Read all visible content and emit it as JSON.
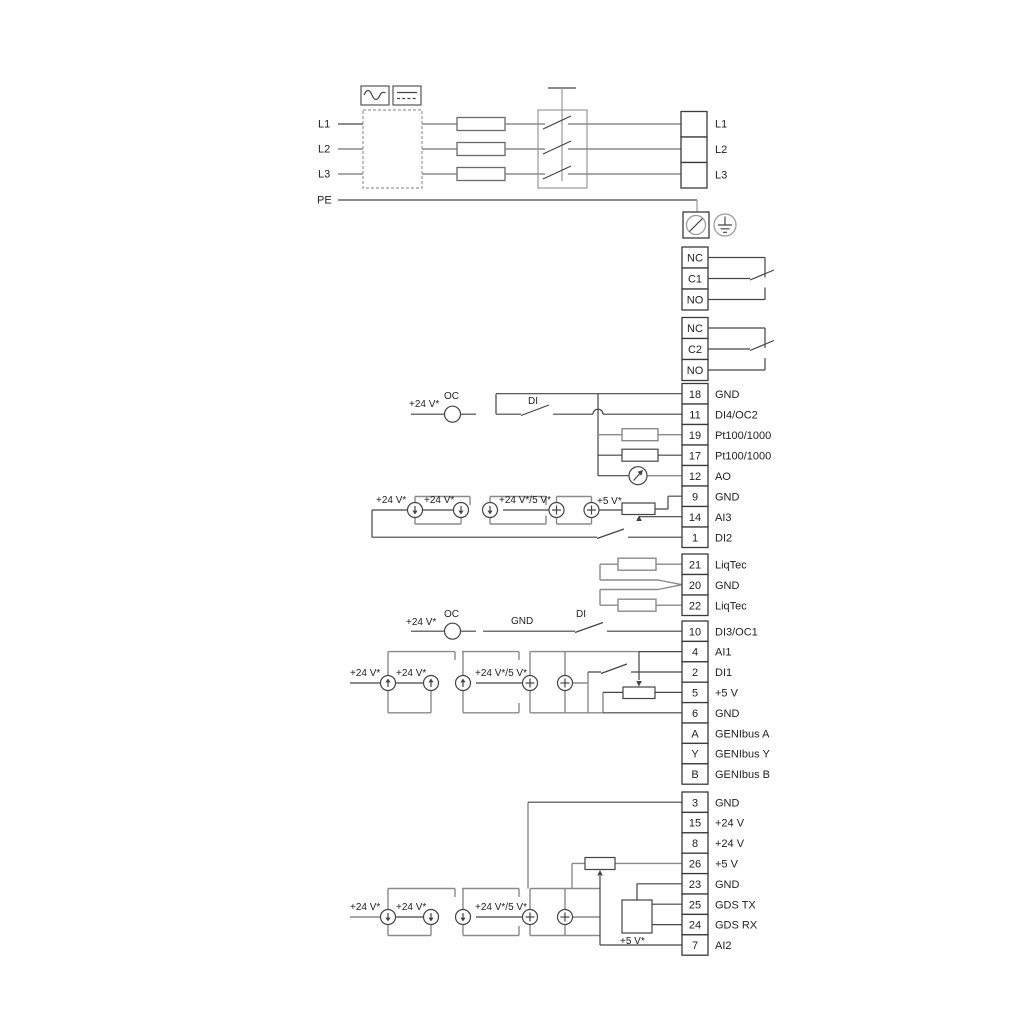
{
  "colors": {
    "wire": "#444444",
    "wire_grey": "#8a8a8a",
    "text": "#222222",
    "background": "#ffffff"
  },
  "power": {
    "inputs": [
      "L1",
      "L2",
      "L3",
      "PE"
    ],
    "out": [
      "L1",
      "L2",
      "L3"
    ]
  },
  "relays": {
    "r1": [
      "NC",
      "C1",
      "NO"
    ],
    "r2": [
      "NC",
      "C2",
      "NO"
    ]
  },
  "terminals": [
    {
      "num": "18",
      "label": "GND"
    },
    {
      "num": "11",
      "label": "DI4/OC2"
    },
    {
      "num": "19",
      "label": "Pt100/1000"
    },
    {
      "num": "17",
      "label": "Pt100/1000"
    },
    {
      "num": "12",
      "label": "AO"
    },
    {
      "num": "9",
      "label": "GND"
    },
    {
      "num": "14",
      "label": "AI3"
    },
    {
      "num": "1",
      "label": "DI2"
    },
    {
      "num": "21",
      "label": "LiqTec"
    },
    {
      "num": "20",
      "label": "GND"
    },
    {
      "num": "22",
      "label": "LiqTec"
    },
    {
      "num": "10",
      "label": "DI3/OC1"
    },
    {
      "num": "4",
      "label": "AI1"
    },
    {
      "num": "2",
      "label": "DI1"
    },
    {
      "num": "5",
      "label": "+5 V"
    },
    {
      "num": "6",
      "label": "GND"
    },
    {
      "num": "A",
      "label": "GENIbus A"
    },
    {
      "num": "Y",
      "label": "GENIbus Y"
    },
    {
      "num": "B",
      "label": "GENIbus B"
    },
    {
      "num": "3",
      "label": "GND"
    },
    {
      "num": "15",
      "label": "+24 V"
    },
    {
      "num": "8",
      "label": "+24 V"
    },
    {
      "num": "26",
      "label": "+5 V"
    },
    {
      "num": "23",
      "label": "GND"
    },
    {
      "num": "25",
      "label": "GDS TX"
    },
    {
      "num": "24",
      "label": "GDS RX"
    },
    {
      "num": "7",
      "label": "AI2"
    }
  ],
  "ann": {
    "di4": {
      "v24": "+24 V*",
      "oc": "OC",
      "di": "DI"
    },
    "ai3": {
      "l1": "+24 V*",
      "l2": "+24 V*",
      "l3": "+24 V*/5 V*",
      "l4": "+5 V*"
    },
    "di3": {
      "v24": "+24 V*",
      "oc": "OC",
      "gnd": "GND",
      "di": "DI"
    },
    "ai1": {
      "l1": "+24 V*",
      "l2": "+24 V*",
      "l3": "+24 V*/5 V*"
    },
    "ai2": {
      "l1": "+24 V*",
      "l2": "+24 V*",
      "l3": "+24 V*/5 V*",
      "v5": "+5 V*"
    }
  }
}
